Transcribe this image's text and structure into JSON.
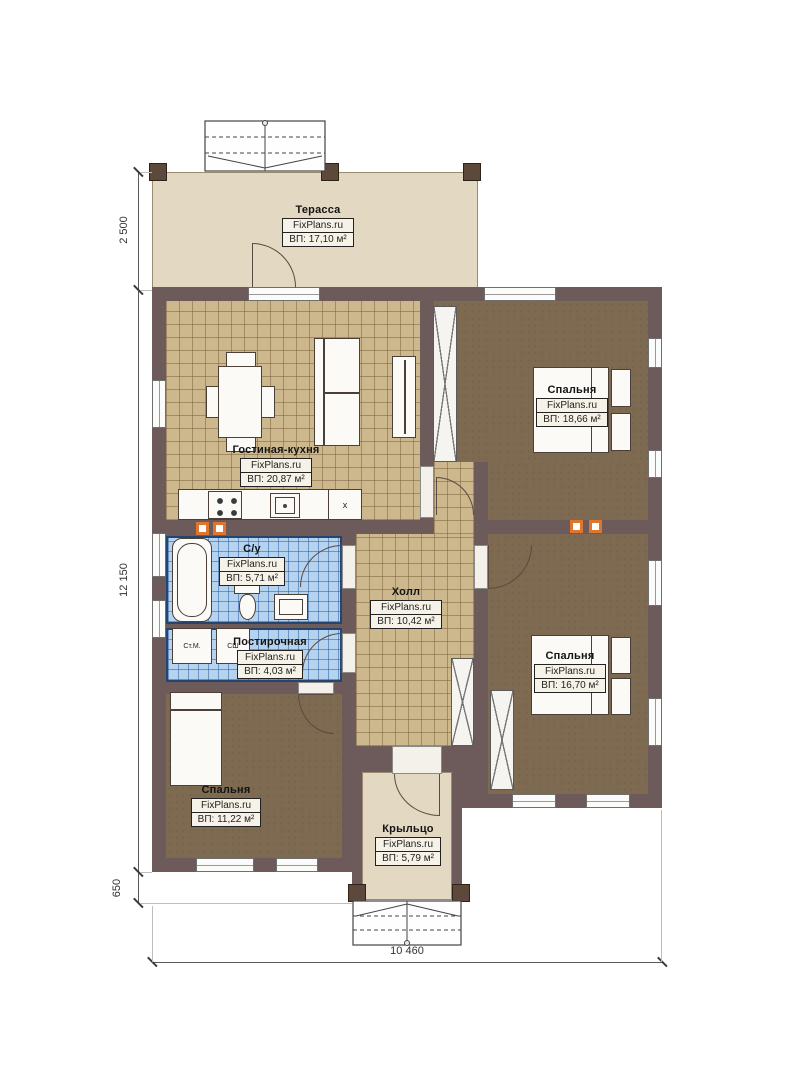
{
  "plan": {
    "rooms": {
      "terrace": {
        "name": "Терасса",
        "brand": "FixPlans.ru",
        "area": "ВП: 17,10 м²"
      },
      "living_kitchen": {
        "name": "Гостиная-кухня",
        "brand": "FixPlans.ru",
        "area": "ВП: 20,87 м²"
      },
      "bedroom_top_right": {
        "name": "Спальня",
        "brand": "FixPlans.ru",
        "area": "ВП: 18,66 м²"
      },
      "bathroom": {
        "name": "С/у",
        "brand": "FixPlans.ru",
        "area": "ВП: 5,71 м²"
      },
      "hall": {
        "name": "Холл",
        "brand": "FixPlans.ru",
        "area": "ВП: 10,42 м²"
      },
      "laundry": {
        "name": "Постирочная",
        "brand": "FixPlans.ru",
        "area": "ВП: 4,03 м²"
      },
      "bedroom_right": {
        "name": "Спальня",
        "brand": "FixPlans.ru",
        "area": "ВП: 16,70 м²"
      },
      "bedroom_bottom_left": {
        "name": "Спальня",
        "brand": "FixPlans.ru",
        "area": "ВП: 11,22 м²"
      },
      "porch": {
        "name": "Крыльцо",
        "brand": "FixPlans.ru",
        "area": "ВП: 5,79 м²"
      }
    },
    "appliances": {
      "washing_machine": "Ст.М.",
      "drying_cabinet": "СШ",
      "fridge": "x"
    },
    "dimensions": {
      "terrace_depth": "2 500",
      "house_depth": "12 150",
      "porch_step": "650",
      "house_width": "10 460"
    },
    "colors": {
      "wall": "#6d5a5a",
      "terrace_floor": "#e3d8c2",
      "tile_floor": "#cdb78c",
      "bedroom_floor": "#7d6a51",
      "bath_tile": "#b5d2ef",
      "vent_accent": "#e0762e"
    }
  }
}
